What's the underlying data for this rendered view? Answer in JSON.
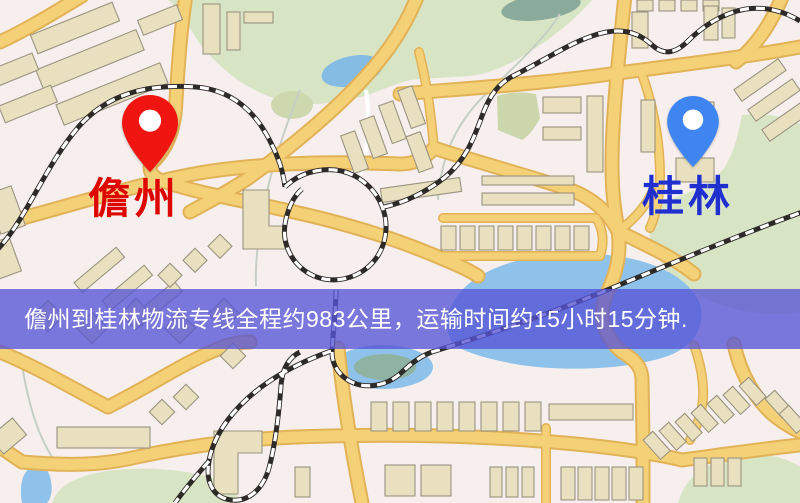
{
  "route_banner": {
    "text": "儋州到桂林物流专线全程约983公里，运输时间约15小时15分钟.",
    "origin": "儋州",
    "destination": "桂林",
    "distance": "约983公里",
    "duration": "约15小时15分钟",
    "background_color": "#5654d6",
    "text_color": "#ffffff"
  },
  "markers": {
    "origin": {
      "label": "儋州",
      "pin_color": "#f01511",
      "label_color": "#dd0600"
    },
    "destination": {
      "label": "桂林",
      "pin_color": "#3f85f2",
      "label_color": "#2030cf"
    }
  },
  "map_palette": {
    "background": "#f6efee",
    "road_fill": "#f4d077",
    "road_edge": "#e2b257",
    "minor_road": "#ffffff",
    "building_fill": "#e9e0bf",
    "building_outline": "#9b9480",
    "park_green": "#d8e5c5",
    "water_blue": "#8fc2ea",
    "railway_dark": "#2e2a28"
  }
}
